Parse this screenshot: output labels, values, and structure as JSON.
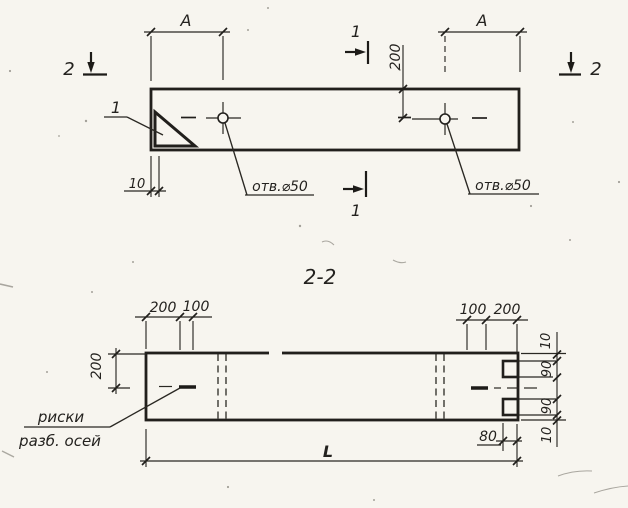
{
  "colors": {
    "ink": "#24221f",
    "paper": "#f7f5ef"
  },
  "plan_view": {
    "dim_a_left": "A",
    "dim_a_right": "A",
    "dim_edge_to_hole": "200",
    "dim_chamfer": "10",
    "hole_label_left": "отв.⌀50",
    "hole_label_right": "отв.⌀50",
    "detail_callout": "1",
    "section_1_top": "1",
    "section_1_bottom": "1",
    "section_2_left": "2",
    "section_2_right": "2"
  },
  "section_view": {
    "title": "2-2",
    "dim_left_height": "200",
    "dim_top_left_outer": "200",
    "dim_top_left_inner": "100",
    "dim_top_right_inner": "100",
    "dim_top_right_outer": "200",
    "dim_right_top_edge": "10",
    "dim_right_notch_top": "90",
    "dim_right_notch_bottom": "90",
    "dim_right_bottom_edge": "10",
    "dim_notch_depth": "80",
    "dim_length": "L",
    "axes_label_line1": "риски",
    "axes_label_line2": "разб. осей"
  }
}
